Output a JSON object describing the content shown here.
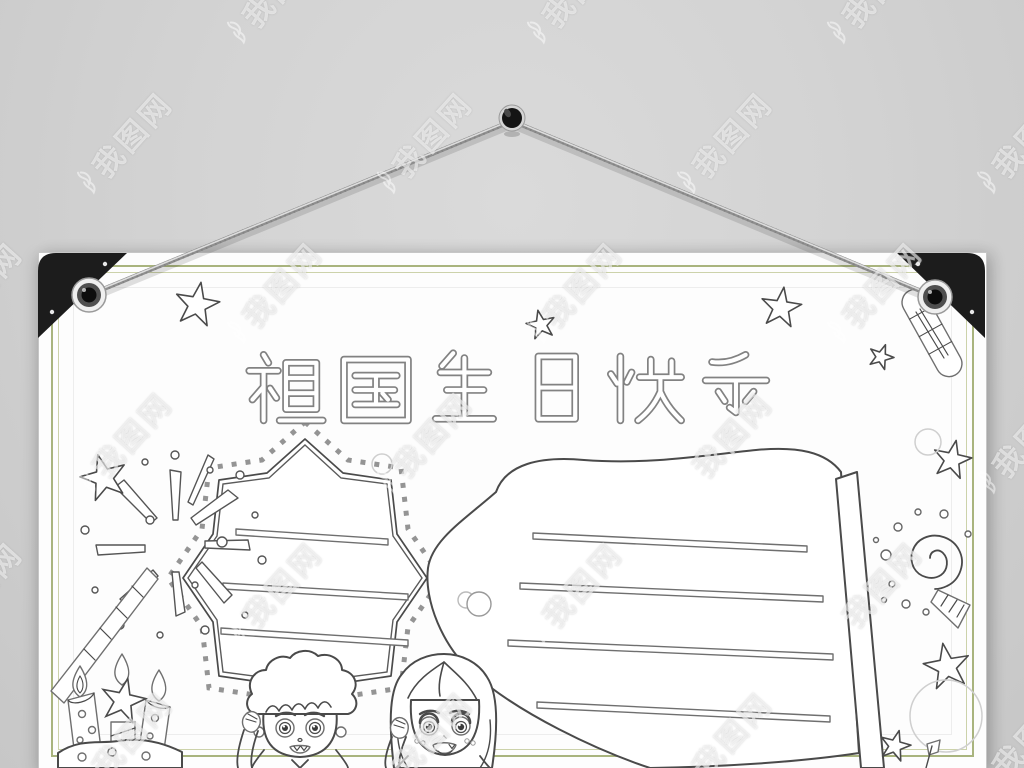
{
  "title": {
    "text": "祖国生日快乐"
  },
  "watermark": {
    "text": "我图网",
    "logo": "flame-icon"
  },
  "panels": {
    "left": {
      "shape": "octagon-star",
      "writing_lines": 3,
      "border_style": "dotted-squares"
    },
    "right": {
      "shape": "waving-flag-on-pole",
      "writing_lines": 4
    }
  },
  "decorations": [
    "pushpin",
    "hanging-strings",
    "corner-protectors",
    "metal-grommets",
    "fireworks-burst",
    "sparkler-stick",
    "birthday-cake-with-candles",
    "star-candle",
    "saluting-boy",
    "saluting-girl",
    "party-horn-swirl",
    "outline-stars",
    "balloon",
    "firecracker",
    "mini-flag"
  ],
  "colors": {
    "wall": "#d2d2d2",
    "poster": "#fdfdfd",
    "border_accent": "#a9b47e",
    "corner_protector": "#1c1c1c",
    "ink": "#4a4a4a"
  }
}
